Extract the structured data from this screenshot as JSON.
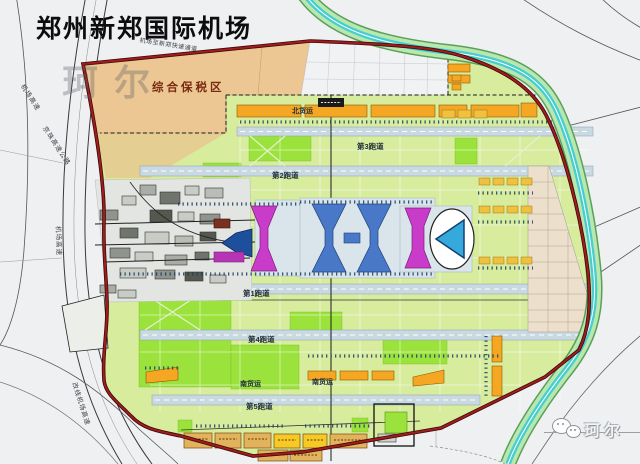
{
  "title": "郑州新郑国际机场",
  "labels": {
    "bonded_zone": "综合保税区",
    "north_cargo": "北货运",
    "south_cargo_west": "南货运",
    "south_cargo_east": "南货运",
    "runway_1": "第1跑道",
    "runway_2": "第2跑道",
    "runway_3": "第3跑道",
    "runway_4": "第4跑道",
    "runway_5": "第5跑道"
  },
  "roads": {
    "airport_expressway_nw": "机场高速",
    "jingzhu_expressway": "京珠高速公路",
    "airport_expressway_w": "机场高速",
    "relocated_airport_expressway": "改线机场高速",
    "airport_to_xinzheng_expressway": "机场至新郑快速通道"
  },
  "watermarks": {
    "map_center": "珂尔",
    "bottom_right": "珂尔"
  },
  "colors": {
    "boundary_red": "#a11c1c",
    "airfield_green": "#d7ec9d",
    "bright_green": "#9be23c",
    "bonded_zone_tan": "#ecc793",
    "cargo_orange": "#f5a623",
    "terminal_magenta": "#c93cc9",
    "concourse_blue": "#4a78c8",
    "satellite_blue": "#35a8dc",
    "canal_teal": "#45cdd0"
  }
}
